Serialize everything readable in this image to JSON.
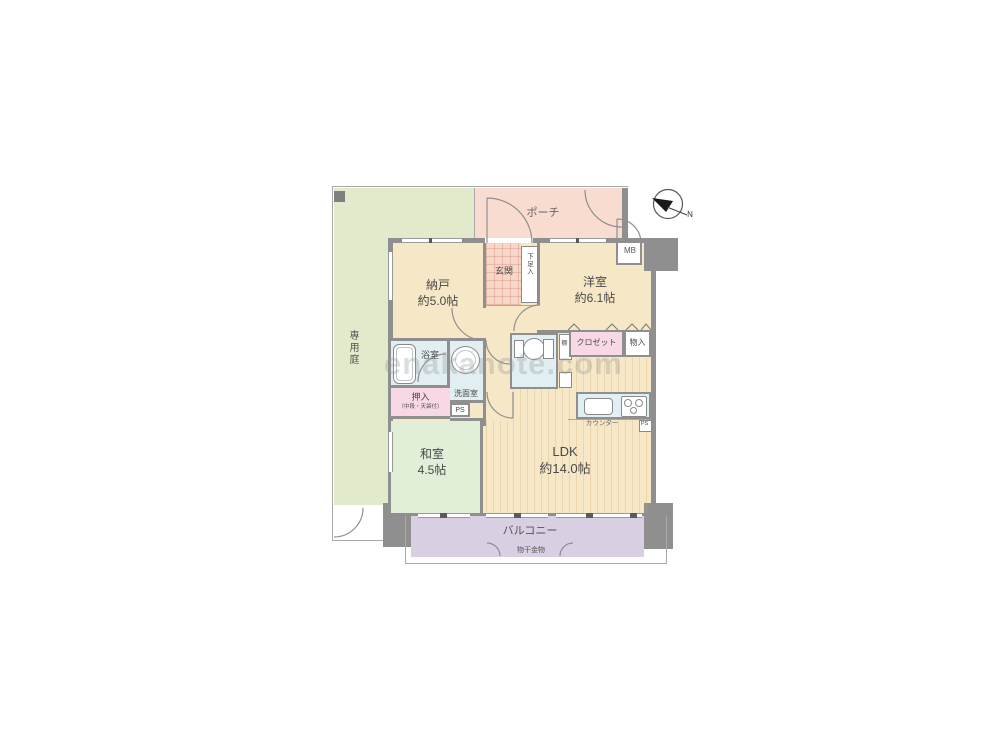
{
  "watermark": "enakanote.com",
  "compass": {
    "north": "N"
  },
  "outdoor": {
    "garden": "専用庭",
    "porch": "ポーチ",
    "balcony": "バルコニー",
    "laundry_hardware": "物干金物"
  },
  "rooms": {
    "storage_room": {
      "name": "納戸",
      "size": "約5.0帖"
    },
    "entrance": {
      "name": "玄関"
    },
    "shoe_box": {
      "name": "下足入"
    },
    "western_room": {
      "name": "洋室",
      "size": "約6.1帖"
    },
    "meter_box": {
      "name": "MB"
    },
    "bathroom": {
      "name": "浴室"
    },
    "washroom": {
      "name": "洗面室"
    },
    "toilet_shelf": {
      "name": "棚"
    },
    "closet": {
      "name": "クロゼット"
    },
    "storage": {
      "name": "物入"
    },
    "futon_closet": {
      "name": "押入",
      "note": "（中段・天袋付）"
    },
    "pipe_space": {
      "name": "PS"
    },
    "japanese_room": {
      "name": "和室",
      "size": "4.5帖"
    },
    "ldk": {
      "name": "LDK",
      "size": "約14.0帖"
    },
    "counter": {
      "name": "カウンター"
    },
    "pipe_space_kitchen": {
      "name": "PS"
    }
  }
}
